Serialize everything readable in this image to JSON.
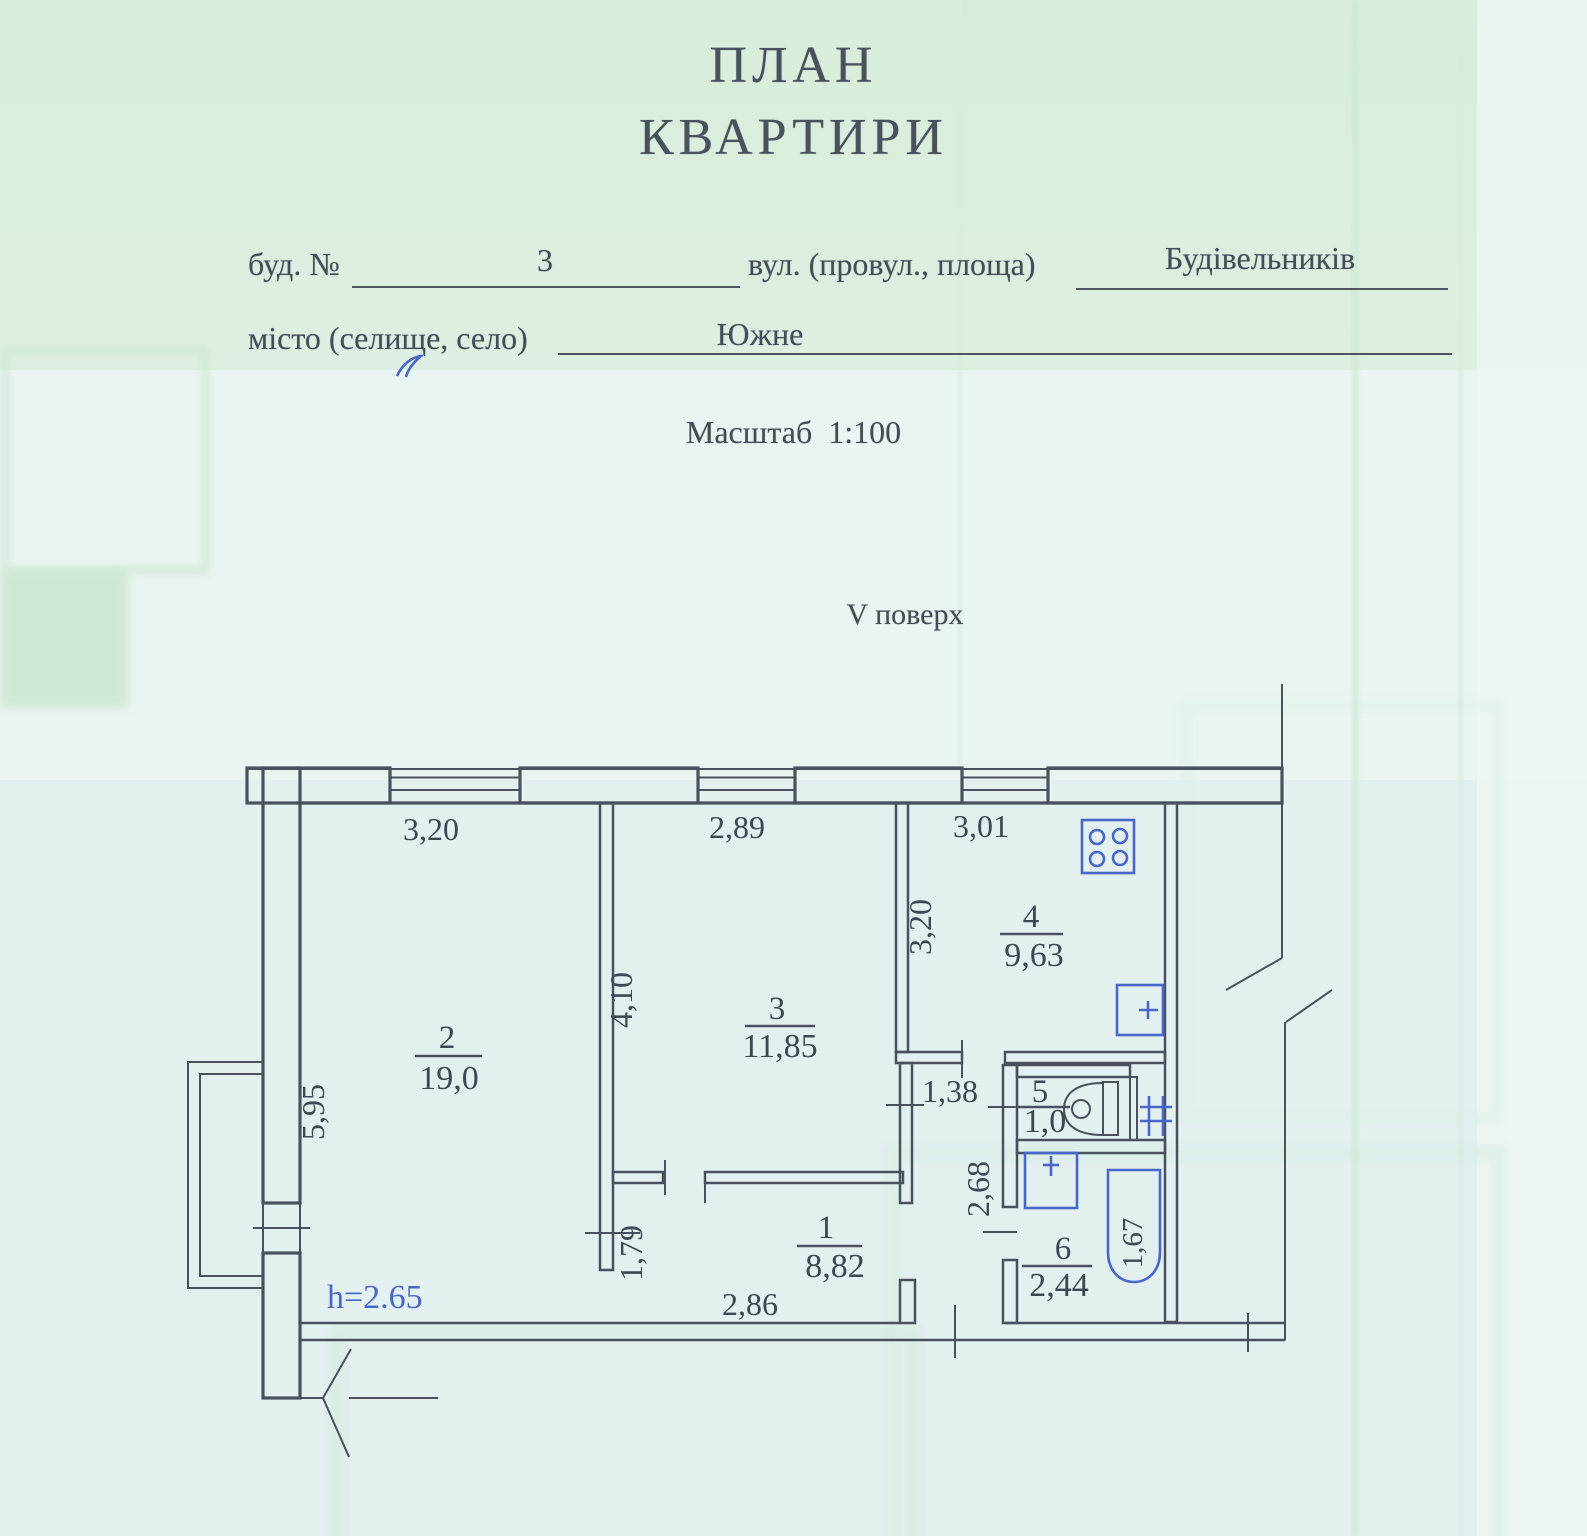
{
  "document": {
    "title_line1": "ПЛАН",
    "title_line2": "КВАРТИРИ",
    "form": {
      "building_label": "буд. №",
      "building_value": "3",
      "street_label": "вул. (провул., площа)",
      "street_value": "Будівельників",
      "city_label": "місто (селище, село)",
      "city_value": "Южне"
    },
    "scale_text": "Масштаб  1:100",
    "floor_text": "V поверх"
  },
  "plan": {
    "height_note": "h=2.65",
    "rooms": {
      "hall": {
        "number": "1",
        "area": "8,82"
      },
      "living": {
        "number": "2",
        "area": "19,0"
      },
      "bedroom": {
        "number": "3",
        "area": "11,85"
      },
      "kitchen": {
        "number": "4",
        "area": "9,63"
      },
      "wc": {
        "number": "5",
        "area": "1,0"
      },
      "bathroom": {
        "number": "6",
        "area": "2,44"
      }
    },
    "dimensions": {
      "window_left": "3,20",
      "window_middle": "2,89",
      "window_right": "3,01",
      "left_wall": "5,95",
      "bedroom_width": "4,10",
      "kitchen_width": "3,20",
      "corridor_width": "1,38",
      "hall_width": "1,79",
      "hall_length": "2,86",
      "bath_width": "2,68",
      "bathtub_length": "1,67"
    },
    "fixtures": {
      "stove": "stove",
      "kitchen_sink": "sink",
      "toilet": "toilet",
      "vent": "ventilation-grid",
      "washbasin": "washbasin",
      "bathtub": "bathtub"
    },
    "colors": {
      "ink": "#49525c",
      "fixture_blue": "#4966c8",
      "note_blue": "#4a66cc"
    }
  }
}
